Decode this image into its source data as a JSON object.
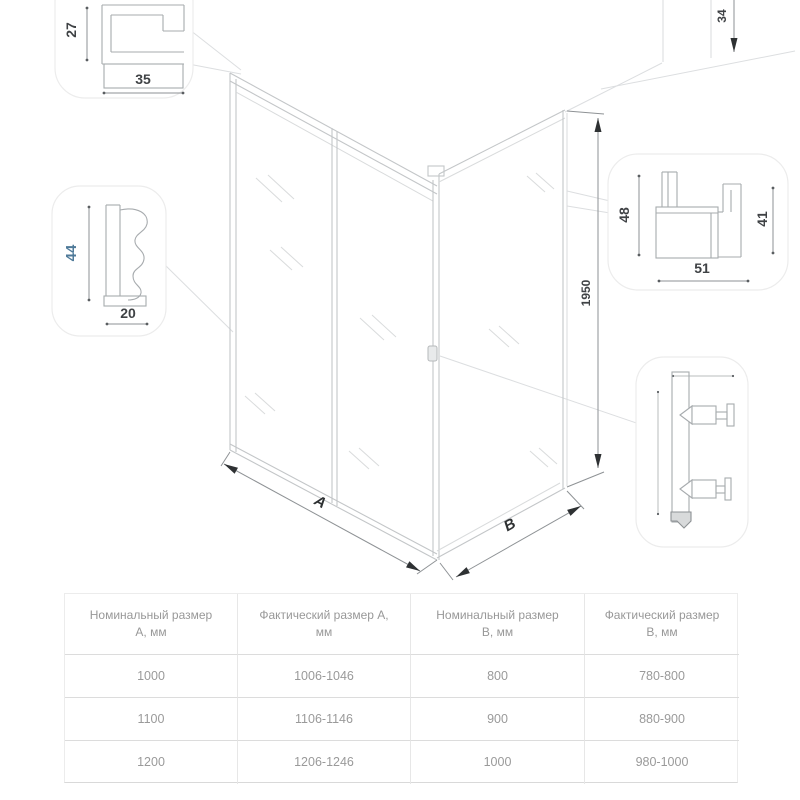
{
  "drawing": {
    "width_label": "A",
    "depth_label": "B",
    "height_dim": "1950",
    "top_dim": "34"
  },
  "details": {
    "top_profile": {
      "height": "27",
      "width": "35"
    },
    "wall_profile": {
      "height": "44",
      "depth": "20"
    },
    "corner_profile": {
      "height_left": "48",
      "height_right": "41",
      "width": "51"
    }
  },
  "colors": {
    "accent": "#4f7a99"
  },
  "table": {
    "headers": [
      "Номинальный размер A, мм",
      "Фактический размер A, мм",
      "Номинальный размер B, мм",
      "Фактический размер B, мм"
    ],
    "rows": [
      [
        "1000",
        "1006-1046",
        "800",
        "780-800"
      ],
      [
        "1100",
        "1106-1146",
        "900",
        "880-900"
      ],
      [
        "1200",
        "1206-1246",
        "1000",
        "980-1000"
      ]
    ]
  }
}
